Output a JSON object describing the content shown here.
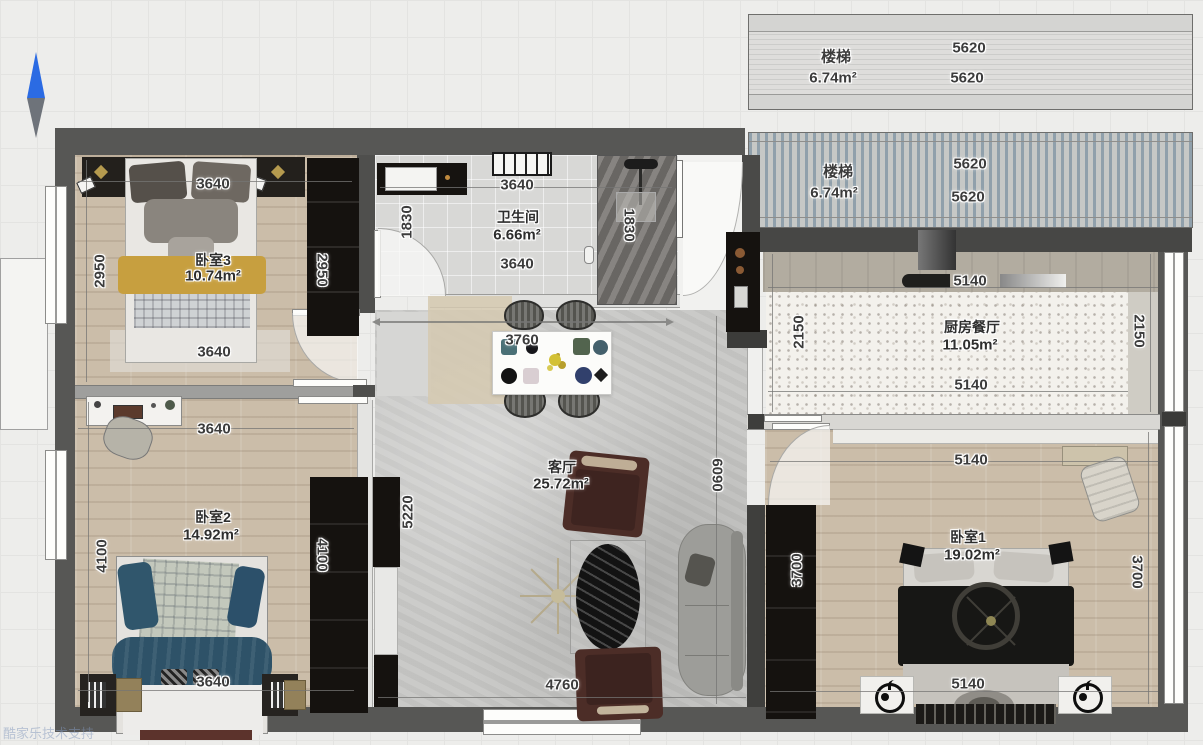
{
  "watermark": "酷家乐技术支持",
  "stairs_top": {
    "name": "楼梯",
    "area": "6.74m²",
    "dim_a": "5620",
    "dim_b": "5620"
  },
  "stairs_mid": {
    "name": "楼梯",
    "area": "6.74m²",
    "dim_a": "5620",
    "dim_b": "5620"
  },
  "rooms": {
    "bedroom3": {
      "label": "卧室3",
      "area": "10.74m²",
      "dims": {
        "top": "3640",
        "left": "2950",
        "right": "2950",
        "bottom": "3640"
      }
    },
    "bathroom": {
      "label": "卫生间",
      "area": "6.66m²",
      "dims": {
        "top": "3640",
        "left": "1830",
        "right": "1830",
        "bottom": "3640"
      }
    },
    "kitchen": {
      "label": "厨房餐厅",
      "area": "11.05m²",
      "dims": {
        "top": "5140",
        "left": "2150",
        "right": "2150",
        "bottom": "5140"
      }
    },
    "living": {
      "label": "客厅",
      "area": "25.72m²",
      "dims": {
        "table": "3760",
        "left": "5220",
        "right": "6090",
        "bottom": "4760"
      }
    },
    "bedroom2": {
      "label": "卧室2",
      "area": "14.92m²",
      "dims": {
        "top": "3640",
        "left": "4100",
        "right": "4100",
        "bottom": "3640"
      }
    },
    "bedroom1": {
      "label": "卧室1",
      "area": "19.02m²",
      "dims": {
        "top": "5140",
        "left": "3700",
        "right": "3700",
        "bottom": "5140"
      }
    }
  },
  "colors": {
    "north_blue": "#2b6be3",
    "wall_gray": "#575755",
    "bed_yellow": "#c79f3f",
    "bed_blue": "#2e5268",
    "chair_maroon": "#4c2d27",
    "watermark_blue": "#8298bc"
  }
}
